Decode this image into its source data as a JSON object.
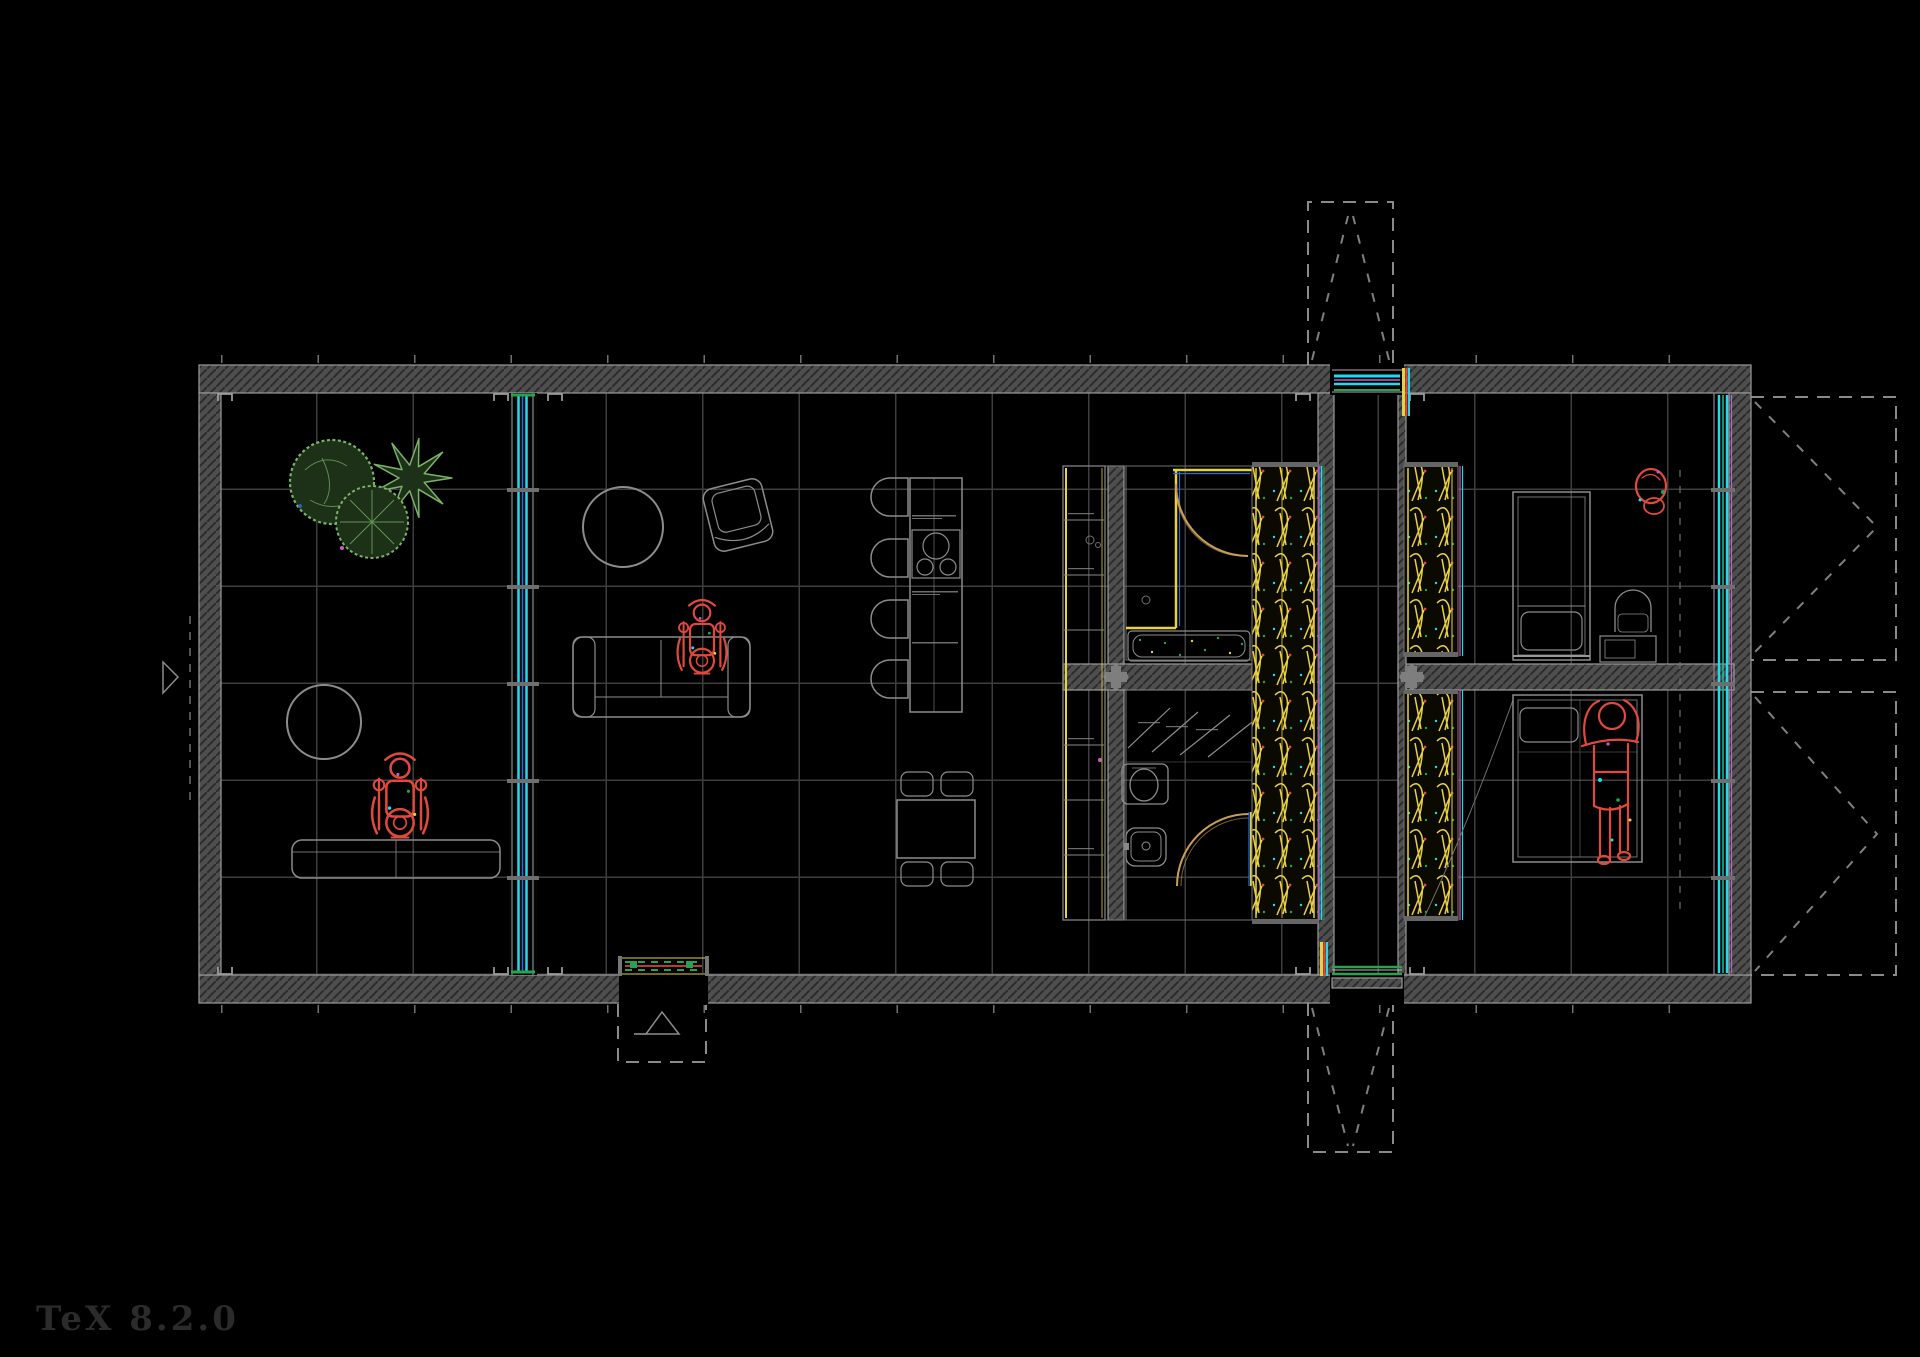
{
  "meta": {
    "drawing_type": "architectural-floor-plan-cad-dark",
    "watermark": "TeX 8.2.0"
  },
  "colors": {
    "background": "#000000",
    "grid": "#3e3e3e",
    "wall-fill": "#4e4e4e",
    "wall-hatch": "#2b2b2b",
    "wall-edge": "#9b9b9b",
    "outline": "#8c8c8c",
    "dashed": "#8a8a8a",
    "glazing-cyan": "#25d9ec",
    "glazing-blue": "#2e6bd6",
    "glazing-green": "#27a34f",
    "fixture-yellow": "#e8d243",
    "door-arc-tan": "#c99f54",
    "figure-red": "#e04a3c",
    "plant-green": "#7ab368",
    "accent-magenta": "#c45ec4",
    "watermark-gray": "#2e2e2e"
  },
  "plan": {
    "grid": {
      "columns": 16,
      "rows": 6
    },
    "zones": [
      {
        "name": "winter-garden",
        "items": [
          "round-tree",
          "star-tree",
          "cross-tree",
          "round-table",
          "bench",
          "wheelchair-figure"
        ]
      },
      {
        "name": "living-room",
        "items": [
          "round-table",
          "armchair",
          "sofa",
          "wheelchair-figure"
        ]
      },
      {
        "name": "kitchen-dining",
        "items": [
          "dining-table",
          "four-chairs",
          "counter",
          "cooktop",
          "four-stools"
        ]
      },
      {
        "name": "bathroom-upper",
        "items": [
          "shower-walls",
          "door-swing",
          "bathtub",
          "shelf-column"
        ]
      },
      {
        "name": "bathroom-lower",
        "items": [
          "folding-rack",
          "toilet",
          "washbasin",
          "door-swing"
        ]
      },
      {
        "name": "wardrobe-left",
        "items": [
          "hanger-rail"
        ]
      },
      {
        "name": "entry-corridor",
        "items": [
          "glazed-door-top",
          "glazed-door-bottom"
        ]
      },
      {
        "name": "wardrobe-right",
        "items": [
          "hanger-rail-upper",
          "hanger-rail-lower"
        ]
      },
      {
        "name": "bedroom-upper",
        "items": [
          "single-bed",
          "desk",
          "chair",
          "red-marker"
        ]
      },
      {
        "name": "bedroom-lower",
        "items": [
          "double-bed",
          "lying-figure"
        ]
      }
    ],
    "outside": [
      "ramp-top",
      "ramp-bottom",
      "entry-porch",
      "terrace-upper-right",
      "terrace-lower-right",
      "section-marker-left"
    ]
  }
}
